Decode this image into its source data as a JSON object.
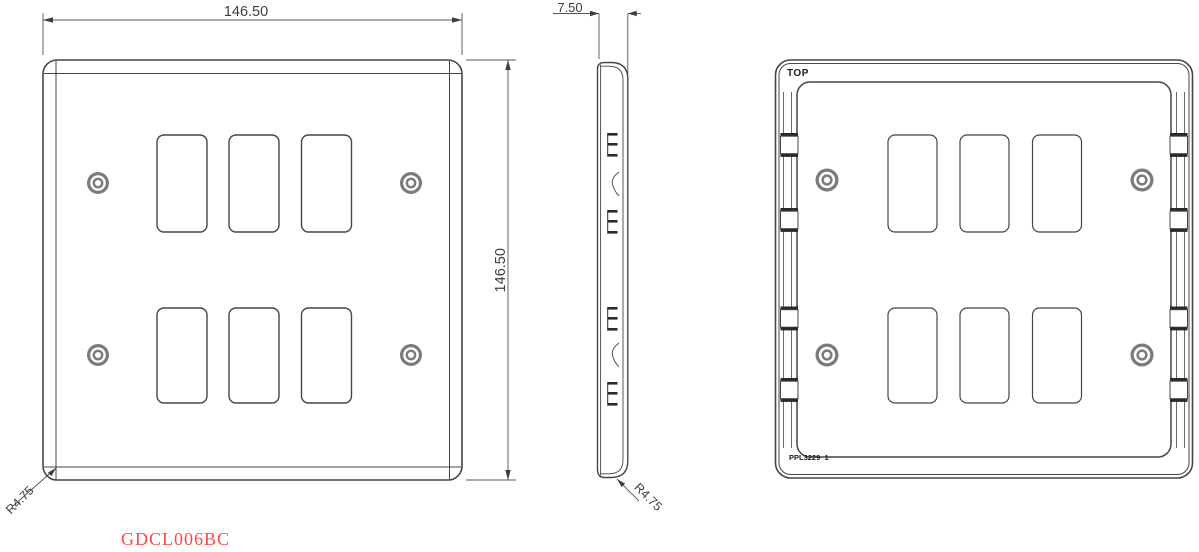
{
  "drawing": {
    "part_number": "GDCL006BC",
    "views": {
      "front": {
        "dimensions": {
          "width": "146.50",
          "height": "146.50",
          "corner_radius": "R4.75"
        },
        "cutout_count": 6,
        "screw_count": 4
      },
      "side": {
        "dimensions": {
          "depth": "7.50",
          "corner_radius": "R4.75"
        }
      },
      "rear": {
        "labels": {
          "orientation": "TOP",
          "mould_ref": "PPL3229  1"
        },
        "cutout_count": 6,
        "screw_count": 4
      }
    },
    "colors": {
      "line": "#454545",
      "part_number_red": "#ff4646",
      "screw_gray": "#7b7b7b"
    }
  }
}
